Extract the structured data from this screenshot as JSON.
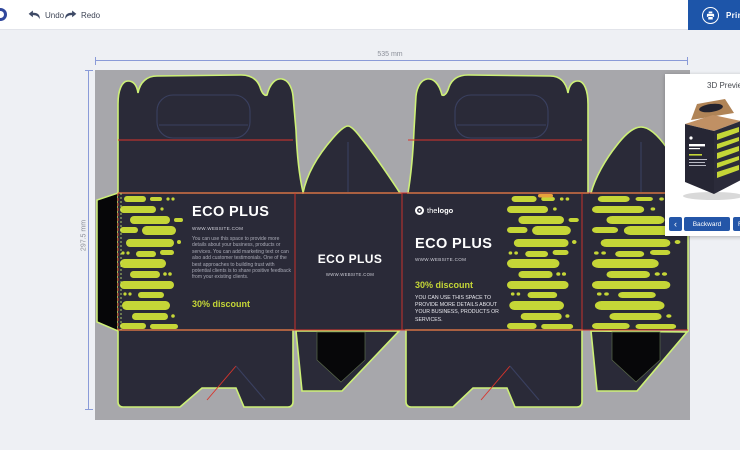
{
  "toolbar": {
    "undo": "Undo",
    "redo": "Redo",
    "print": "Print"
  },
  "dimensions": {
    "width": "535 mm",
    "height": "297.5 mm"
  },
  "design": {
    "front": {
      "title": "ECO PLUS",
      "website": "WWW.WEBSITE.COM",
      "body": "You can use this space to provide more details about your business, products or services. You can add marketing text or can also add customer testimonials. One of the best approaches to building trust with potential clients is to share positive feedback from your existing clients.",
      "discount": "30% discount"
    },
    "side": {
      "title": "ECO PLUS",
      "website": "WWW.WEBSITE.COM"
    },
    "back": {
      "logo_prefix": "the",
      "logo_suffix": "logo",
      "title": "ECO PLUS",
      "website": "WWW.WEBSITE.COM",
      "discount": "30% discount",
      "body": "YOU CAN USE THIS SPACE TO PROVIDE MORE DETAILS ABOUT YOUR BUSINESS, PRODUCTS OR SERVICES."
    }
  },
  "preview": {
    "title": "3D Preview",
    "prev_arrow": "‹",
    "backward": "Backward",
    "forward": "Forward"
  },
  "colors": {
    "accent_blue": "#1d55a9",
    "die_green": "#cdf077",
    "pattern_yellow": "#c5d637",
    "fold_red": "#d9342b",
    "panel_dark": "#2a2a38",
    "canvas_gray": "#a7a7ab"
  }
}
